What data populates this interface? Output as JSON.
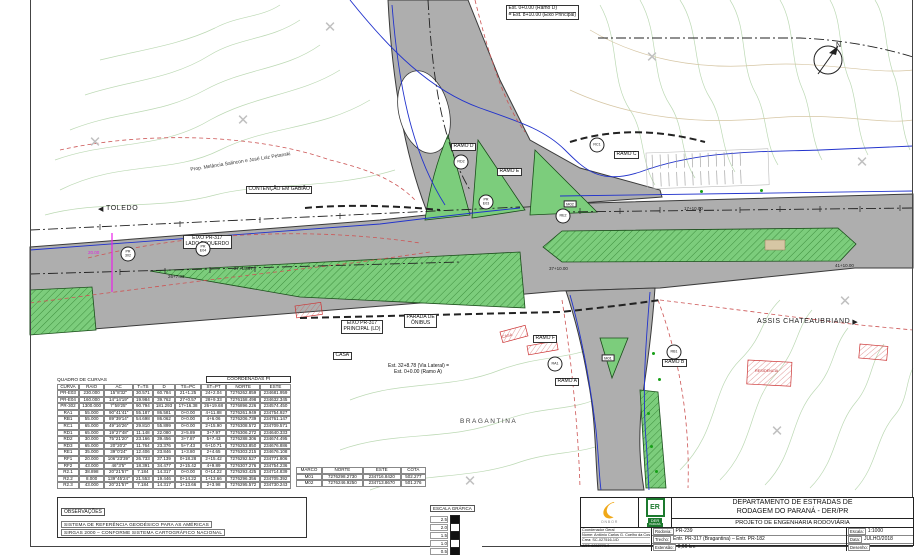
{
  "map": {
    "icons": {
      "arrow_left": "◀",
      "arrow_right": "▶",
      "cross": "✕",
      "triangle": "▲"
    },
    "north_label": "N",
    "cities": {
      "toledo": "TOLEDO",
      "assis": "ASSIS CHATEAUBRIAND",
      "bragantina": "BRAGANTINA"
    },
    "notes": {
      "est_ramo_d_line1": "Est. 0+0.00 (Ramo D)",
      "est_ramo_d_line2": "= Est. 8+10.00 (Eixo Principal)",
      "est_ramo_a_line1": "Est. 32+8.78 (Via Lateral) =",
      "est_ramo_a_line2": "Est. 0+0.00 (Ramo A)",
      "eixo_esquerdo_line1": "EIXO PR-317",
      "eixo_esquerdo_line2": "LADO ESQUERDO",
      "eixo_principal_line1": "EIXO PR-317",
      "eixo_principal_line2": "PRINCIPAL (LD)",
      "parada_line1": "PARADA DE",
      "parada_line2": "ÔNIBUS",
      "contencao": "CONTENÇÃO EM GABIÃO",
      "prop": "Prop. Melância Salincon e José Luiz Petanski",
      "casa": "CASA",
      "residencia": "RESIDENCIA"
    },
    "ramps": [
      {
        "label": "RAMO D",
        "x": 451,
        "y": 143
      },
      {
        "label": "RAMO E",
        "x": 497,
        "y": 168
      },
      {
        "label": "RAMO C",
        "x": 614,
        "y": 151
      },
      {
        "label": "RAMO F",
        "x": 533,
        "y": 335
      },
      {
        "label": "RAMO B",
        "x": 662,
        "y": 359
      },
      {
        "label": "RAMO A",
        "x": 555,
        "y": 378
      }
    ],
    "markers": [
      {
        "lines": [
          "RC1"
        ],
        "x": 597,
        "y": 145,
        "shape": "circle"
      },
      {
        "lines": [
          "RD2"
        ],
        "x": 461,
        "y": 162,
        "shape": "circle"
      },
      {
        "lines": [
          "RE2"
        ],
        "x": 563,
        "y": 216,
        "shape": "circle"
      },
      {
        "lines": [
          "RA1"
        ],
        "x": 555,
        "y": 364,
        "shape": "circle"
      },
      {
        "lines": [
          "RB1"
        ],
        "x": 674,
        "y": 352,
        "shape": "circle"
      },
      {
        "lines": [
          "PR",
          "E03"
        ],
        "x": 486,
        "y": 202,
        "shape": "circle"
      },
      {
        "lines": [
          "PR",
          "E04"
        ],
        "x": 203,
        "y": 249,
        "shape": "circle"
      },
      {
        "lines": [
          "PR",
          "302"
        ],
        "x": 128,
        "y": 254,
        "shape": "circle"
      },
      {
        "lines": [
          "M01"
        ],
        "x": 608,
        "y": 358,
        "shape": "box"
      },
      {
        "lines": [
          "M02"
        ],
        "x": 570,
        "y": 204,
        "shape": "box"
      }
    ],
    "stations": [
      {
        "text": "17+10.00",
        "x": 684,
        "y": 206
      },
      {
        "text": "37+10.00",
        "x": 549,
        "y": 266
      },
      {
        "text": "41+10.00",
        "x": 835,
        "y": 263
      },
      {
        "text": "27+15.97",
        "x": 234,
        "y": 266
      },
      {
        "text": "26+7.33",
        "x": 168,
        "y": 274
      },
      {
        "text": "20.00",
        "x": 88,
        "y": 250,
        "color": "#e020e0"
      }
    ],
    "survey_crosses": [
      [
        95,
        142
      ],
      [
        243,
        120
      ],
      [
        330,
        27
      ],
      [
        652,
        57
      ],
      [
        862,
        162
      ],
      [
        845,
        301
      ],
      [
        777,
        431
      ],
      [
        470,
        481
      ],
      [
        120,
        471
      ]
    ],
    "green_dots": [
      [
        652,
        352
      ],
      [
        658,
        378
      ],
      [
        647,
        412
      ],
      [
        650,
        445
      ],
      [
        655,
        470
      ],
      [
        700,
        190
      ],
      [
        760,
        189
      ]
    ]
  },
  "curve_table": {
    "title": "QUADRO DE CURVAS",
    "coord_header": "COORDENADAS PI",
    "headers": [
      "CURVA",
      "RAIO",
      "AC",
      "T=TS",
      "D",
      "TS=PC",
      "ST=PT",
      "NORTE",
      "ESTE"
    ],
    "rows": [
      [
        "PR-E03",
        "230.000",
        "15°8'32\"",
        "30.571",
        "60.784",
        "21+1.25",
        "24+2.04",
        "7276262.859",
        "234681.959"
      ],
      [
        "PR-E04",
        "160.000",
        "14°14'19\"",
        "19.984",
        "39.762",
        "27+0.57",
        "28+9.33",
        "7276158.498",
        "234632.345"
      ],
      [
        "PR-302",
        "1300.000",
        "7°59'25\"",
        "90.794",
        "181.293",
        "17+16.38",
        "26+19.68",
        "7276896.226",
        "234574.450"
      ],
      [
        "RA1",
        "55.000",
        "90°41'41\"",
        "55.187",
        "86.581",
        "0+0.00",
        "4+11.88",
        "7276261.949",
        "234754.927"
      ],
      [
        "RB1",
        "55.000",
        "89°39'14\"",
        "54.698",
        "86.062",
        "0+0.00",
        "4+6.06",
        "7276206.739",
        "234761.147"
      ],
      [
        "RC1",
        "65.000",
        "49°16'26\"",
        "29.810",
        "55.899",
        "0+0.00",
        "2+15.90",
        "7276308.572",
        "234709.571"
      ],
      [
        "RD1",
        "65.000",
        "19°27'48\"",
        "11.148",
        "22.080",
        "2+5.89",
        "3+7.97",
        "7276306.272",
        "234640.333"
      ],
      [
        "RD2",
        "30.000",
        "75°21'20\"",
        "23.166",
        "39.456",
        "3+7.87",
        "5+7.43",
        "7276288.306",
        "234674.495"
      ],
      [
        "RD3",
        "65.000",
        "20°20'2\"",
        "11.764",
        "23.376",
        "5+7.43",
        "6+10.71",
        "7276253.850",
        "234676.886"
      ],
      [
        "RE1",
        "35.000",
        "39°0'24\"",
        "12.406",
        "23.846",
        "1+3.80",
        "2+4.65",
        "7276303.215",
        "234676.108"
      ],
      [
        "RF1",
        "20.000",
        "106°23'39\"",
        "26.733",
        "37.139",
        "0+18.28",
        "2+15.42",
        "7276292.527",
        "234771.806"
      ],
      [
        "RF2",
        "43.000",
        "46°3'5\"",
        "18.391",
        "34.477",
        "2+15.42",
        "4+9.89",
        "7276307.276",
        "234754.236"
      ],
      [
        "R2.1",
        "38.898",
        "20°21'57\"",
        "7.184",
        "14.317",
        "0+0.00",
        "0+14.22",
        "7276293.425",
        "234714.839"
      ],
      [
        "R2.2",
        "8.000",
        "139°45'24\"",
        "21.553",
        "19.446",
        "0+14.22",
        "1+13.66",
        "7276296.356",
        "234705.392"
      ],
      [
        "R2.3",
        "43.000",
        "20°21'57\"",
        "7.184",
        "14.317",
        "1+13.66",
        "2+3.98",
        "7276295.572",
        "234730.243"
      ]
    ]
  },
  "marco_table": {
    "headers": [
      "MARCO",
      "NORTE",
      "ESTE",
      "COTA"
    ],
    "rows": [
      [
        "M01",
        "7276298.2730",
        "234716.8420",
        "502.277"
      ],
      [
        "M02",
        "7276246.9250",
        "234713.8670",
        "501.276"
      ]
    ]
  },
  "observacoes": {
    "title": "OBSERVAÇÕES",
    "line1": "SISTEMA DE REFERÊNCIA GEODÉSICO PARA AS AMÉRICAS",
    "line2": "SIRGAS 2000 – CONFORME SISTEMA CARTOGRÁFICO NACIONAL"
  },
  "scale_bar": {
    "title": "ESCALA GRÁFICA",
    "ticks": [
      "2.5",
      "2.0",
      "1.5",
      "1.0",
      "0.5"
    ]
  },
  "title_block": {
    "org1": "DEPARTAMENTO DE ESTRADAS DE",
    "org2": "RODAGEM DO PARANÁ - DER/PR",
    "project": "PROJETO DE ENGENHARIA RODOVIÁRIA",
    "onbor_name": "ONBOR",
    "der_letters": "ER",
    "der_name": "DER",
    "der_sub": "PARANÁ",
    "coordenador": "Coordenador Geral",
    "nome_label": "Nome:",
    "nome": "Antônio Carlos G. Coelho da Costa",
    "crea_label": "Crea:",
    "crea": "SC-027516-1/D",
    "art_label": "ART:",
    "art": "6052773-9",
    "rodovia_label": "Rodovia:",
    "rodovia": "PR-239",
    "trecho_label": "Trecho:",
    "trecho": "Entr. PR-317 (Bragantina) – Entr. PR-182",
    "extensao_label": "Extensão:",
    "extensao": "9,66 km",
    "escala_label": "Escala:",
    "escala": "1:1000",
    "data_label": "Data:",
    "data": "JULHO/2018",
    "desenho_label": "Desenho:"
  }
}
